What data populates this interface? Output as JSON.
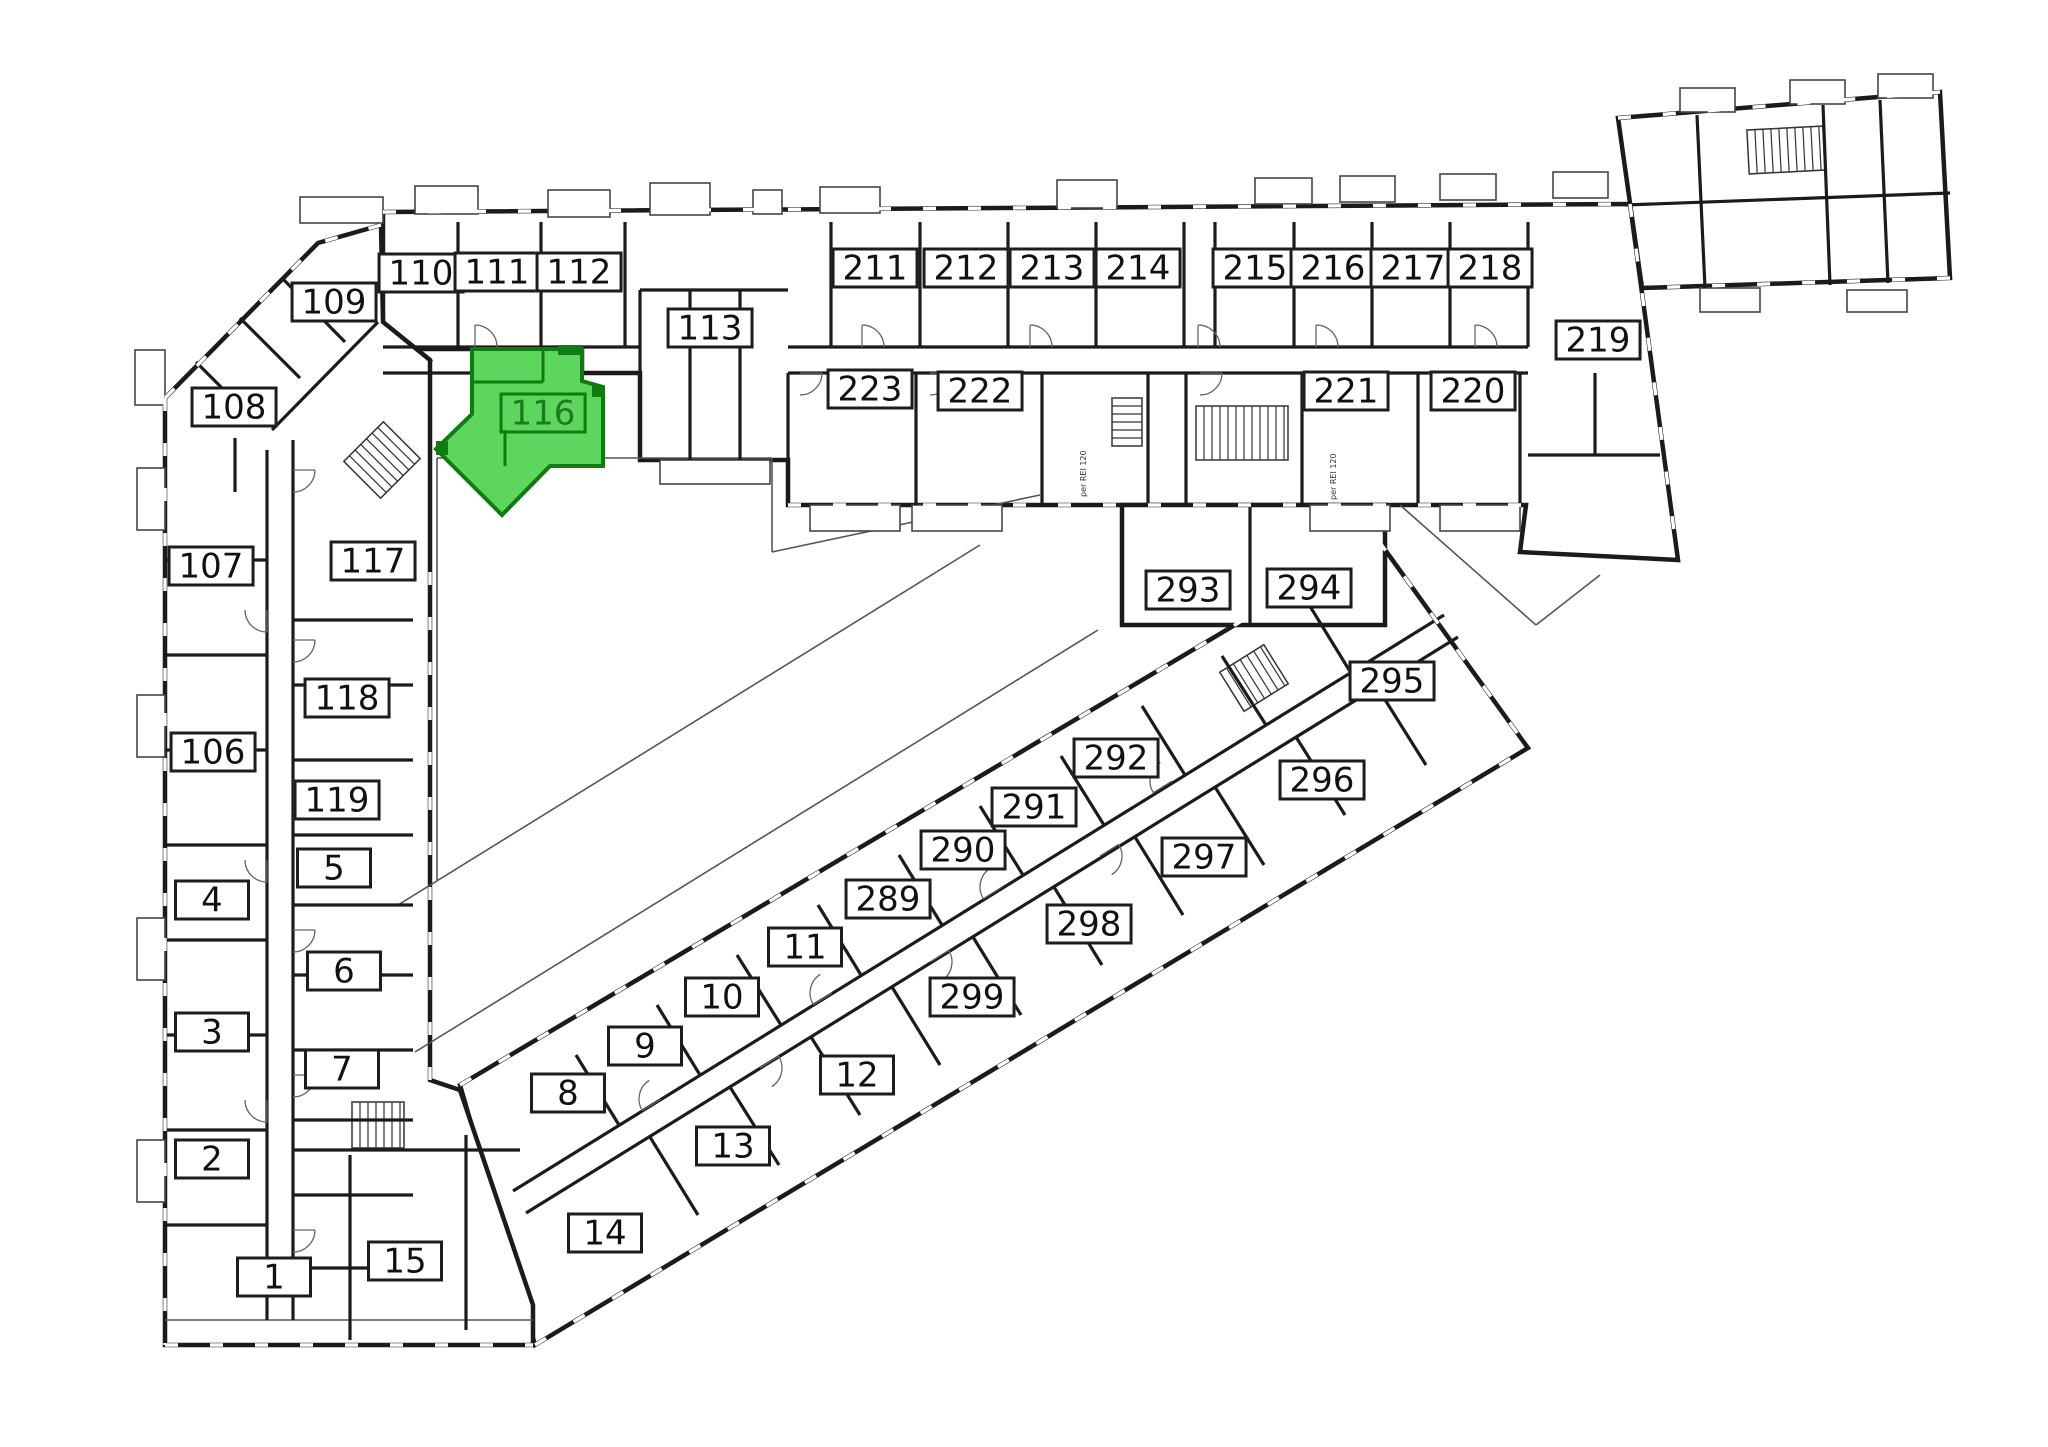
{
  "canvas": {
    "w": 2048,
    "h": 1447
  },
  "colors": {
    "background": "#ffffff",
    "wall": "#1b1b1b",
    "thin_line": "#555555",
    "label_bg": "#ffffff",
    "label_border": "#1d1d1d",
    "label_text": "#111111",
    "highlight_fill": "#5cd65c",
    "highlight_stroke": "#117a11",
    "highlight_text": "#1e7a1e",
    "annotation_text": "#333333"
  },
  "highlighted_unit": {
    "number": "116",
    "polygon": "472,349 582,349 582,381 603,387 603,466 550,466 502,515 436,449 472,414",
    "interior_lines": [
      [
        472,
        382,
        543,
        382
      ],
      [
        543,
        349,
        543,
        382
      ],
      [
        505,
        430,
        505,
        466
      ]
    ],
    "accent_squares": [
      [
        558,
        345,
        24,
        10
      ],
      [
        592,
        385,
        12,
        12
      ],
      [
        436,
        441,
        12,
        14
      ]
    ]
  },
  "units": [
    {
      "n": "110",
      "x": 421,
      "y": 273
    },
    {
      "n": "111",
      "x": 497,
      "y": 272
    },
    {
      "n": "112",
      "x": 579,
      "y": 272
    },
    {
      "n": "109",
      "x": 334,
      "y": 302
    },
    {
      "n": "113",
      "x": 710,
      "y": 328
    },
    {
      "n": "211",
      "x": 875,
      "y": 268
    },
    {
      "n": "212",
      "x": 966,
      "y": 268
    },
    {
      "n": "213",
      "x": 1052,
      "y": 268
    },
    {
      "n": "214",
      "x": 1138,
      "y": 268
    },
    {
      "n": "215",
      "x": 1255,
      "y": 268
    },
    {
      "n": "216",
      "x": 1333,
      "y": 268
    },
    {
      "n": "217",
      "x": 1413,
      "y": 268
    },
    {
      "n": "218",
      "x": 1490,
      "y": 268
    },
    {
      "n": "219",
      "x": 1598,
      "y": 340
    },
    {
      "n": "223",
      "x": 870,
      "y": 389
    },
    {
      "n": "222",
      "x": 980,
      "y": 391
    },
    {
      "n": "221",
      "x": 1346,
      "y": 391
    },
    {
      "n": "220",
      "x": 1473,
      "y": 391
    },
    {
      "n": "108",
      "x": 234,
      "y": 407
    },
    {
      "n": "116",
      "x": 543,
      "y": 413,
      "hl": true
    },
    {
      "n": "107",
      "x": 211,
      "y": 566
    },
    {
      "n": "117",
      "x": 373,
      "y": 561
    },
    {
      "n": "106",
      "x": 213,
      "y": 752
    },
    {
      "n": "118",
      "x": 347,
      "y": 698
    },
    {
      "n": "119",
      "x": 337,
      "y": 800
    },
    {
      "n": "5",
      "x": 334,
      "y": 868
    },
    {
      "n": "4",
      "x": 212,
      "y": 900
    },
    {
      "n": "6",
      "x": 344,
      "y": 971
    },
    {
      "n": "3",
      "x": 212,
      "y": 1032
    },
    {
      "n": "7",
      "x": 342,
      "y": 1069
    },
    {
      "n": "2",
      "x": 212,
      "y": 1159
    },
    {
      "n": "1",
      "x": 274,
      "y": 1277
    },
    {
      "n": "15",
      "x": 405,
      "y": 1261
    },
    {
      "n": "8",
      "x": 568,
      "y": 1093
    },
    {
      "n": "9",
      "x": 645,
      "y": 1046
    },
    {
      "n": "10",
      "x": 722,
      "y": 997
    },
    {
      "n": "11",
      "x": 805,
      "y": 947
    },
    {
      "n": "289",
      "x": 888,
      "y": 899
    },
    {
      "n": "290",
      "x": 963,
      "y": 850
    },
    {
      "n": "291",
      "x": 1034,
      "y": 807
    },
    {
      "n": "292",
      "x": 1116,
      "y": 758
    },
    {
      "n": "14",
      "x": 605,
      "y": 1233
    },
    {
      "n": "13",
      "x": 733,
      "y": 1146
    },
    {
      "n": "12",
      "x": 857,
      "y": 1075
    },
    {
      "n": "299",
      "x": 972,
      "y": 997
    },
    {
      "n": "298",
      "x": 1089,
      "y": 924
    },
    {
      "n": "297",
      "x": 1204,
      "y": 857
    },
    {
      "n": "293",
      "x": 1188,
      "y": 590
    },
    {
      "n": "294",
      "x": 1309,
      "y": 588
    },
    {
      "n": "295",
      "x": 1392,
      "y": 681
    },
    {
      "n": "296",
      "x": 1322,
      "y": 780
    }
  ],
  "annotations": [
    {
      "text": "per REI 120",
      "x": 1086,
      "y": 497
    },
    {
      "text": "per REI 120",
      "x": 1336,
      "y": 500
    }
  ],
  "floorplan": {
    "blocks": [
      "M460,1085 L1378,540 L1528,748 L535,1345 Z",
      "M383,212 L1630,204 L1678,560 L1520,552 L1526,505 L788,505 L788,460 L640,460 L640,373 L582,373 L582,349 L383,349 Z",
      "M381,225 L318,243 L165,398 L165,1345 L533,1345 L533,1305 L460,1090 L430,1080 L430,360 L383,322 Z",
      "M1122,505 L1385,505 L1385,625 L1122,625 Z",
      "M1618,118 L1940,92 L1950,278 L1642,288 Z"
    ],
    "walls": [
      [
        383,
        347,
        640,
        347
      ],
      [
        788,
        347,
        1528,
        347
      ],
      [
        383,
        373,
        640,
        373
      ],
      [
        788,
        373,
        1528,
        373
      ],
      [
        458,
        222,
        458,
        347
      ],
      [
        541,
        222,
        541,
        347
      ],
      [
        625,
        222,
        625,
        347
      ],
      [
        831,
        222,
        831,
        347
      ],
      [
        920,
        222,
        920,
        347
      ],
      [
        1008,
        222,
        1008,
        347
      ],
      [
        1096,
        222,
        1096,
        347
      ],
      [
        1184,
        222,
        1184,
        347
      ],
      [
        1215,
        222,
        1215,
        347
      ],
      [
        1294,
        222,
        1294,
        347
      ],
      [
        1372,
        222,
        1372,
        347
      ],
      [
        1450,
        222,
        1450,
        347
      ],
      [
        1528,
        222,
        1528,
        347
      ],
      [
        788,
        373,
        788,
        505
      ],
      [
        916,
        373,
        916,
        505
      ],
      [
        1042,
        373,
        1042,
        505
      ],
      [
        1148,
        373,
        1148,
        505
      ],
      [
        1186,
        373,
        1186,
        505
      ],
      [
        1302,
        373,
        1302,
        505
      ],
      [
        1418,
        373,
        1418,
        505
      ],
      [
        1520,
        373,
        1520,
        505
      ],
      [
        640,
        290,
        788,
        290
      ],
      [
        640,
        290,
        640,
        373
      ],
      [
        690,
        290,
        690,
        460
      ],
      [
        740,
        290,
        740,
        460
      ],
      [
        1528,
        455,
        1660,
        455
      ],
      [
        1595,
        373,
        1595,
        455
      ],
      [
        267,
        450,
        267,
        1320
      ],
      [
        293,
        440,
        293,
        1320
      ],
      [
        165,
        560,
        267,
        560
      ],
      [
        165,
        655,
        267,
        655
      ],
      [
        165,
        750,
        267,
        750
      ],
      [
        165,
        845,
        267,
        845
      ],
      [
        165,
        940,
        267,
        940
      ],
      [
        165,
        1035,
        267,
        1035
      ],
      [
        165,
        1130,
        267,
        1130
      ],
      [
        165,
        1225,
        267,
        1225
      ],
      [
        293,
        620,
        413,
        620
      ],
      [
        293,
        685,
        413,
        685
      ],
      [
        293,
        760,
        413,
        760
      ],
      [
        293,
        835,
        413,
        835
      ],
      [
        293,
        905,
        413,
        905
      ],
      [
        293,
        975,
        413,
        975
      ],
      [
        293,
        1050,
        413,
        1050
      ],
      [
        293,
        1120,
        413,
        1120
      ],
      [
        293,
        1195,
        413,
        1195
      ],
      [
        293,
        1268,
        413,
        1268
      ],
      [
        350,
        1155,
        350,
        1340
      ],
      [
        466,
        1135,
        466,
        1330
      ],
      [
        293,
        1150,
        520,
        1150
      ],
      [
        378,
        322,
        272,
        430
      ],
      [
        282,
        278,
        345,
        342
      ],
      [
        240,
        318,
        300,
        378
      ],
      [
        196,
        362,
        258,
        424
      ],
      [
        383,
        322,
        432,
        362
      ],
      [
        235,
        438,
        235,
        492
      ],
      [
        1250,
        505,
        1250,
        625
      ],
      [
        513,
        1191,
        1444,
        615
      ],
      [
        526,
        1213,
        1458,
        637
      ],
      [
        619,
        1125,
        576,
        1055
      ],
      [
        700,
        1075,
        657,
        1005
      ],
      [
        781,
        1025,
        737,
        955
      ],
      [
        861,
        975,
        818,
        905
      ],
      [
        942,
        925,
        899,
        855
      ],
      [
        1023,
        875,
        980,
        806
      ],
      [
        1104,
        825,
        1061,
        756
      ],
      [
        1185,
        775,
        1142,
        706
      ],
      [
        1266,
        725,
        1222,
        656
      ],
      [
        1351,
        673,
        1308,
        603
      ],
      [
        650,
        1137,
        698,
        1215
      ],
      [
        730,
        1087,
        779,
        1165
      ],
      [
        811,
        1037,
        860,
        1115
      ],
      [
        892,
        987,
        940,
        1065
      ],
      [
        973,
        937,
        1021,
        1015
      ],
      [
        1054,
        887,
        1102,
        965
      ],
      [
        1135,
        837,
        1183,
        915
      ],
      [
        1215,
        787,
        1264,
        865
      ],
      [
        1296,
        737,
        1345,
        815
      ],
      [
        1377,
        687,
        1426,
        765
      ],
      [
        1697,
        115,
        1705,
        288
      ],
      [
        1823,
        105,
        1830,
        285
      ],
      [
        1880,
        100,
        1888,
        283
      ],
      [
        1625,
        205,
        1950,
        193
      ]
    ],
    "thin_lines": [
      [
        437,
        458,
        772,
        458
      ],
      [
        437,
        458,
        437,
        880
      ],
      [
        772,
        458,
        772,
        552
      ],
      [
        772,
        552,
        1040,
        495
      ],
      [
        415,
        1052,
        1098,
        630
      ],
      [
        398,
        905,
        980,
        545
      ],
      [
        1400,
        505,
        1536,
        625
      ],
      [
        1536,
        625,
        1600,
        575
      ],
      [
        165,
        1320,
        533,
        1320
      ]
    ],
    "balconies": [
      [
        415,
        186,
        63,
        28
      ],
      [
        548,
        190,
        62,
        27
      ],
      [
        650,
        183,
        60,
        32
      ],
      [
        753,
        190,
        29,
        24
      ],
      [
        820,
        187,
        60,
        26
      ],
      [
        1057,
        180,
        60,
        28
      ],
      [
        1255,
        178,
        57,
        26
      ],
      [
        1340,
        176,
        55,
        26
      ],
      [
        1440,
        174,
        56,
        26
      ],
      [
        1553,
        172,
        55,
        26
      ],
      [
        137,
        468,
        28,
        62
      ],
      [
        137,
        695,
        28,
        62
      ],
      [
        137,
        918,
        28,
        62
      ],
      [
        137,
        1140,
        28,
        62
      ],
      [
        300,
        197,
        83,
        26
      ],
      [
        660,
        460,
        110,
        24
      ],
      [
        810,
        505,
        90,
        26
      ],
      [
        912,
        505,
        90,
        26
      ],
      [
        1310,
        505,
        80,
        26
      ],
      [
        1440,
        505,
        80,
        26
      ],
      [
        1700,
        288,
        60,
        24
      ],
      [
        1847,
        290,
        60,
        22
      ],
      [
        135,
        350,
        30,
        55
      ],
      [
        1680,
        88,
        55,
        24
      ],
      [
        1790,
        80,
        55,
        24
      ],
      [
        1878,
        74,
        55,
        24
      ]
    ],
    "stairs": [
      [
        356,
        432,
        52,
        56,
        45
      ],
      [
        1112,
        398,
        30,
        48,
        0
      ],
      [
        1196,
        406,
        92,
        54,
        0
      ],
      [
        1228,
        655,
        52,
        46,
        -32
      ],
      [
        352,
        1102,
        52,
        46,
        0
      ],
      [
        1748,
        128,
        76,
        44,
        -3
      ]
    ],
    "windows": [
      "M383,212 L1630,204",
      "M165,398 L165,1345",
      "M381,225 L318,243 L165,398",
      "M165,1345 L533,1345",
      "M535,1345 L1528,748",
      "M460,1085 L1378,540",
      "M1618,118 L1940,92",
      "M1950,278 L1642,288",
      "M1630,204 L1678,560",
      "M430,1080 L430,560",
      "M1378,540 L1528,748",
      "M788,505 L1526,505"
    ],
    "door_arcs": [
      [
        475,
        347,
        -90
      ],
      [
        862,
        347,
        -90
      ],
      [
        1030,
        347,
        -90
      ],
      [
        1198,
        347,
        -90
      ],
      [
        1316,
        347,
        -90
      ],
      [
        1475,
        347,
        -90
      ],
      [
        800,
        373,
        0
      ],
      [
        930,
        373,
        0
      ],
      [
        1200,
        373,
        0
      ],
      [
        1430,
        373,
        0
      ],
      [
        293,
        470,
        0
      ],
      [
        293,
        640,
        0
      ],
      [
        293,
        790,
        0
      ],
      [
        293,
        930,
        0
      ],
      [
        293,
        1075,
        0
      ],
      [
        293,
        1230,
        0
      ],
      [
        267,
        610,
        90
      ],
      [
        267,
        860,
        90
      ],
      [
        267,
        1100,
        90
      ],
      [
        661,
        1099,
        148
      ],
      [
        832,
        993,
        148
      ],
      [
        1002,
        887,
        148
      ],
      [
        1172,
        781,
        148
      ],
      [
        760,
        1068,
        -32
      ],
      [
        930,
        962,
        -32
      ],
      [
        1100,
        856,
        -32
      ]
    ],
    "arc_radius": 22
  }
}
